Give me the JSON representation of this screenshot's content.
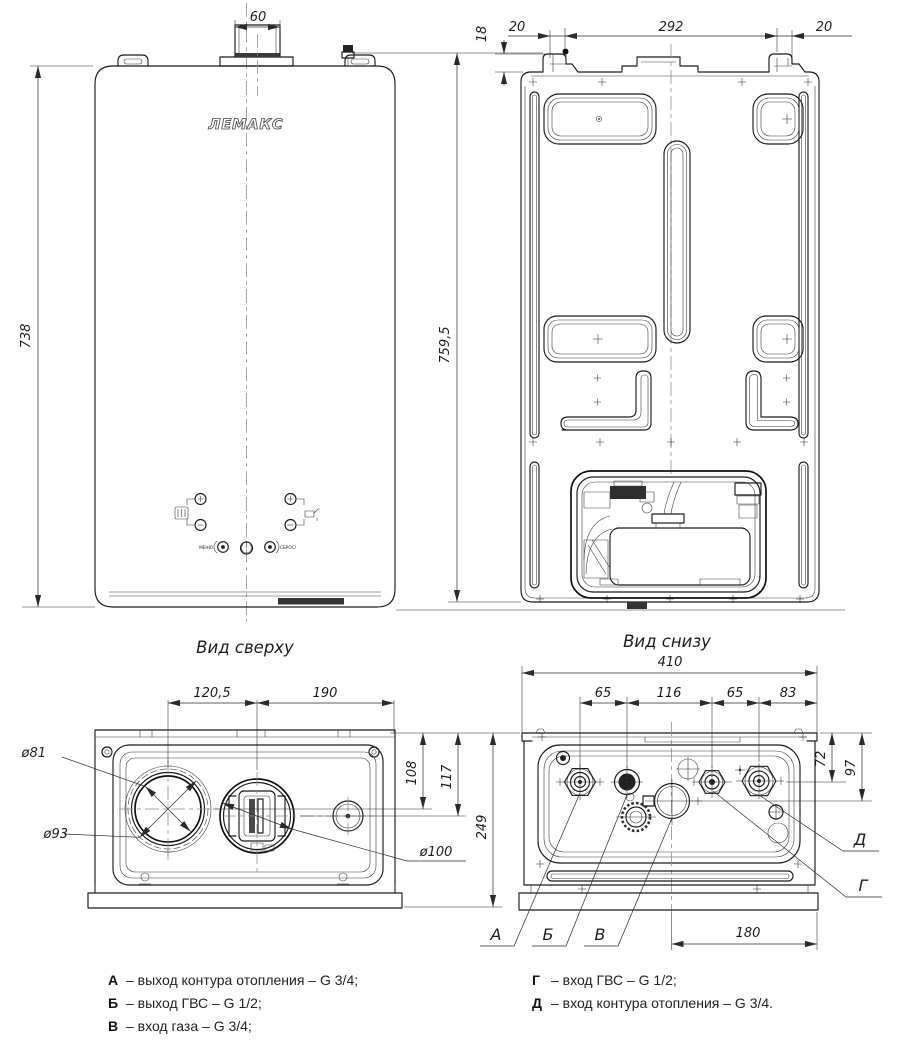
{
  "brand": {
    "logo": "ЛЕМАКС"
  },
  "views": {
    "front": {
      "dim_flue_width": "60",
      "dim_height": "738",
      "dim_overall_height": "759,5",
      "menu_label": "МЕНЮ",
      "reset_label": "СБРОС/"
    },
    "back": {
      "dim_hook_drop": "18",
      "dim_hook_left": "20",
      "dim_hook_span": "292",
      "dim_hook_right": "20"
    },
    "top": {
      "caption": "Вид сверху",
      "dim_flue_to_fan": "120,5",
      "dim_fan_to_edge": "190",
      "dim_dia_flue_inner": "ø81",
      "dim_dia_flue_outer": "ø93",
      "dim_dia_intake": "ø100",
      "dim_depth_flue": "108",
      "dim_depth_fan": "117",
      "dim_depth_total": "249"
    },
    "bottom": {
      "caption": "Вид снизу",
      "dim_width": "410",
      "dim_pitch_ab": "65",
      "dim_pitch_bg": "116",
      "dim_pitch_gd": "65",
      "dim_pitch_d_edge": "83",
      "dim_offset_fittings": "72",
      "dim_offset_gas": "97",
      "dim_gas_to_edge": "180",
      "callouts": {
        "a": "А",
        "b": "Б",
        "v": "В",
        "g": "Г",
        "d": "Д"
      }
    }
  },
  "legend": {
    "items_left": [
      {
        "key": "А",
        "desc": "– выход контура отопления – G 3/4;"
      },
      {
        "key": "Б",
        "desc": "– выход ГВС – G 1/2;"
      },
      {
        "key": "В",
        "desc": "– вход газа – G 3/4;"
      }
    ],
    "items_right": [
      {
        "key": "Г",
        "desc": "– вход ГВС – G 1/2;"
      },
      {
        "key": "Д",
        "desc": "– вход контура отопления – G 3/4."
      }
    ]
  },
  "colors": {
    "line": "#1c1c1c",
    "background": "#ffffff"
  }
}
